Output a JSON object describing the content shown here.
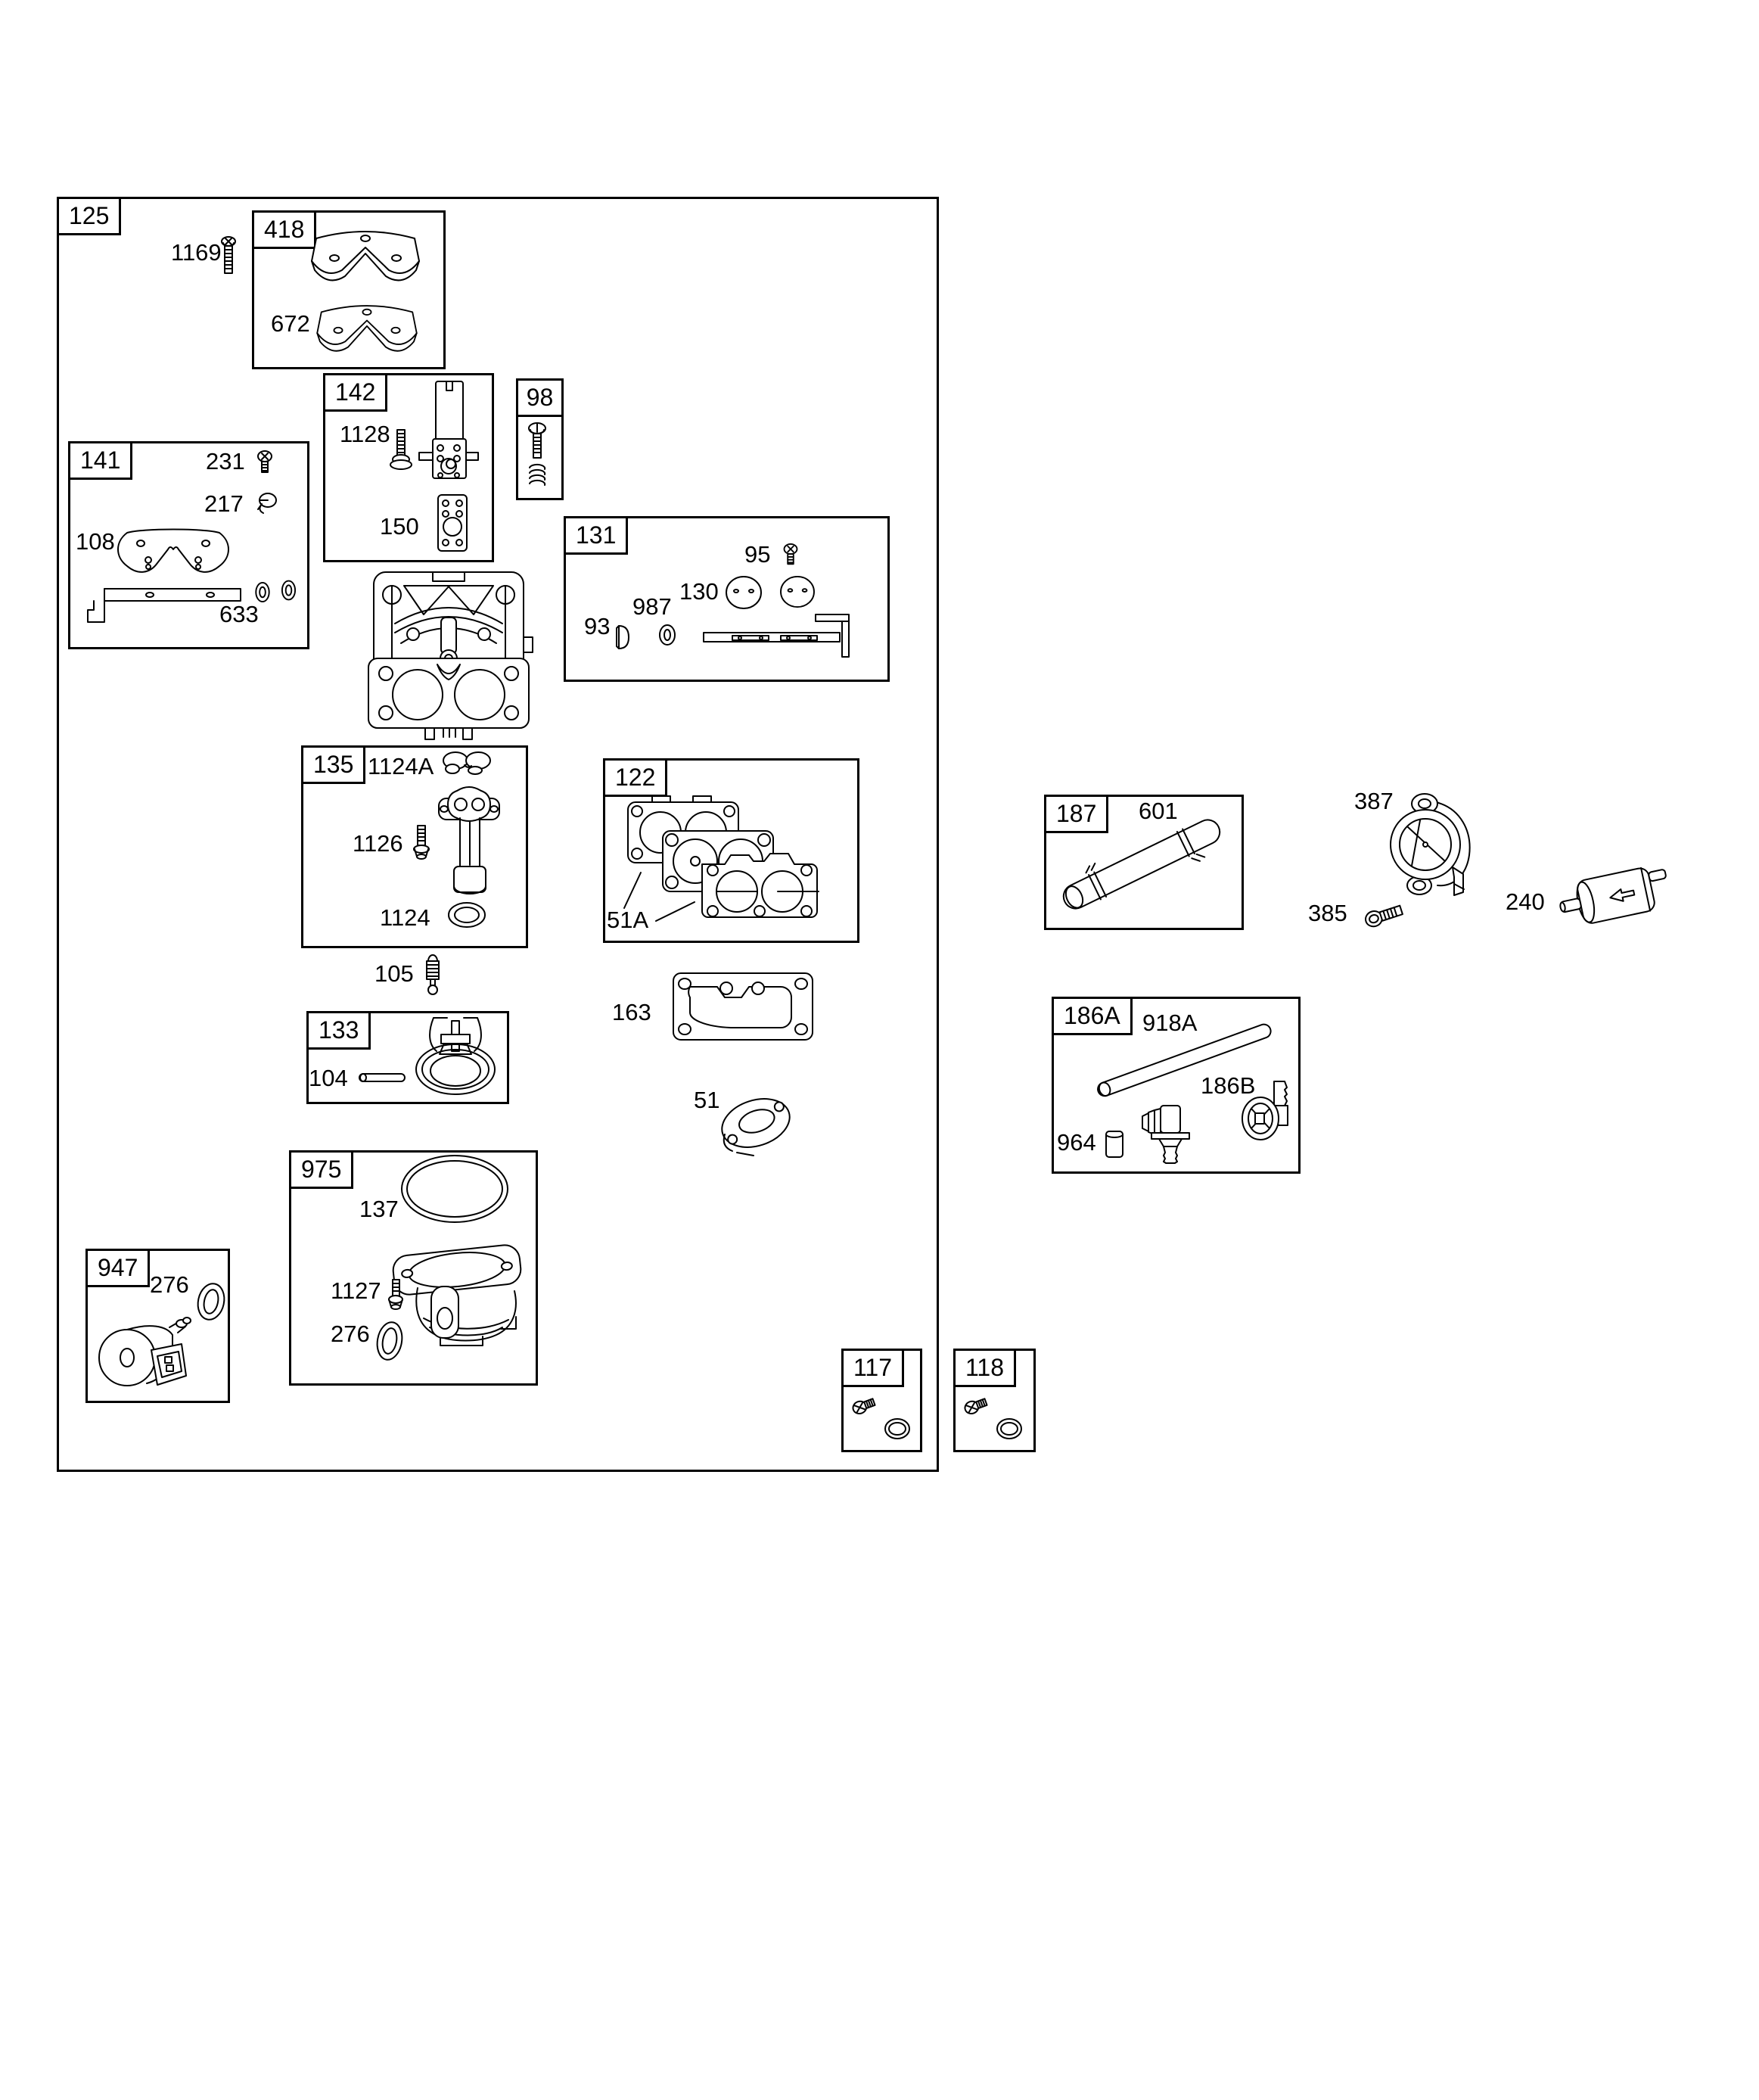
{
  "figure": {
    "g125": {
      "box": "125",
      "p1169": "1169"
    },
    "g418": {
      "box": "418",
      "p672": "672"
    },
    "g142": {
      "box": "142",
      "p1128": "1128",
      "p150": "150"
    },
    "g98": {
      "box": "98"
    },
    "g141": {
      "box": "141",
      "p231": "231",
      "p217": "217",
      "p108": "108",
      "p633": "633"
    },
    "g131": {
      "box": "131",
      "p95": "95",
      "p130": "130",
      "p987": "987",
      "p93": "93"
    },
    "g135": {
      "box": "135",
      "p1124A": "1124A",
      "p1126": "1126",
      "p1124": "1124"
    },
    "g122": {
      "box": "122",
      "p51A": "51A"
    },
    "g133": {
      "box": "133",
      "p104": "104"
    },
    "g975": {
      "box": "975",
      "p137": "137",
      "p1127": "1127",
      "p276": "276"
    },
    "g947": {
      "box": "947",
      "p276": "276"
    },
    "g117": {
      "box": "117"
    },
    "g118": {
      "box": "118"
    },
    "g187": {
      "box": "187",
      "p601": "601"
    },
    "g186A": {
      "box": "186A",
      "p918A": "918A",
      "p186B": "186B",
      "p964": "964"
    },
    "loose": {
      "p105": "105",
      "p163": "163",
      "p51": "51",
      "p387": "387",
      "p385": "385",
      "p240": "240"
    },
    "colors": {
      "line": "#000000",
      "background": "#ffffff"
    }
  }
}
